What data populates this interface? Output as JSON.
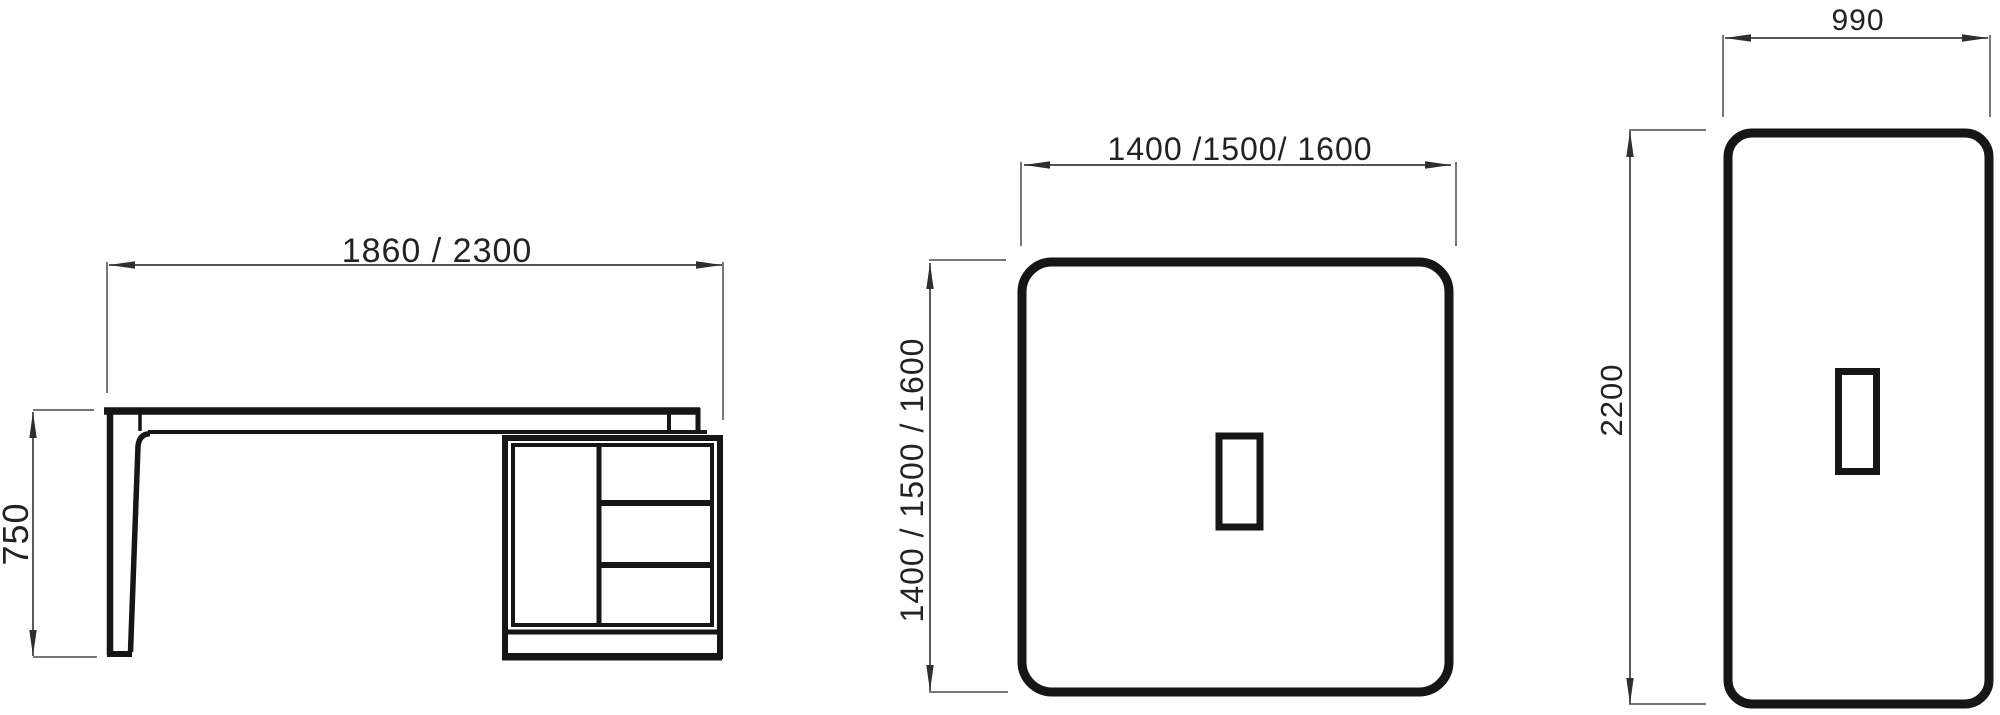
{
  "document": {
    "kind": "furniture technical drawing, three orthographic views",
    "background_color": "#ffffff",
    "outline_color": "#161616",
    "dimension_color": "#3d3d3d",
    "text_color": "#222222"
  },
  "views": {
    "side_elevation": {
      "description": "desk side elevation with tapered leg, cabinet with door, three drawers and plinth",
      "width_dim": "1860 / 2300",
      "height_dim": "750"
    },
    "plan_square": {
      "description": "top plan view, rounded square top with centered cut-out",
      "width_dim": "1400 /1500/ 1600",
      "depth_dim": "1400 / 1500 / 1600"
    },
    "plan_rectangle": {
      "description": "top plan view, rounded rectangular top with cut-out",
      "width_dim": "990",
      "depth_dim": "2200"
    }
  }
}
